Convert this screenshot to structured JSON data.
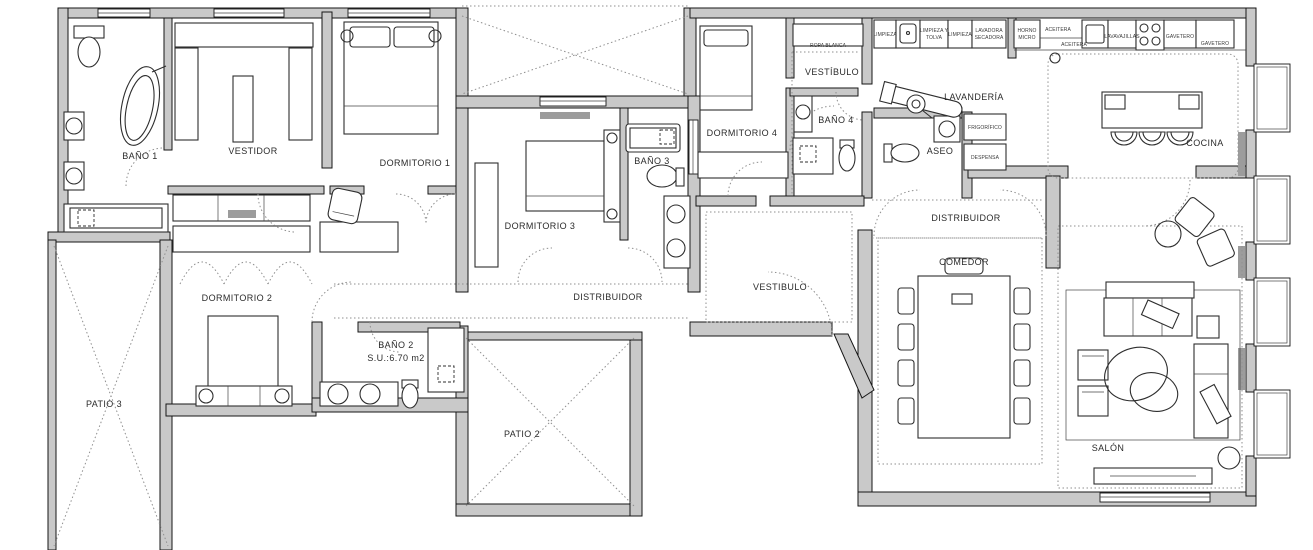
{
  "colors": {
    "wall_fill": "#c9c9c9",
    "line": "#161616",
    "dotted": "#8f8f8f",
    "hatch": "#8f8f8f"
  },
  "rooms": {
    "bano1": "BAÑO 1",
    "vestidor": "VESTIDOR",
    "dormitorio1": "DORMITORIO 1",
    "dormitorio2": "DORMITORIO 2",
    "dormitorio3": "DORMITORIO 3",
    "dormitorio4": "DORMITORIO 4",
    "bano2": "BAÑO 2",
    "bano2_su": "S.U.:6.70 m2",
    "bano3": "BAÑO 3",
    "bano4": "BAÑO 4",
    "aseo": "ASEO",
    "vestibulo_top": "VESTÍBULO",
    "vestibulo_center": "VESTIBULO",
    "lavanderia": "LAVANDERÍA",
    "cocina": "COCINA",
    "comedor": "COMEDOR",
    "salon": "SALÓN",
    "distribuidor_left": "DISTRIBUIDOR",
    "distribuidor_right": "DISTRIBUIDOR",
    "patio2": "PATIO 2",
    "patio3": "PATIO 3"
  },
  "cabinets": {
    "ropa_blanca": "ROPA BLANCA",
    "limpieza1": "LIMPIEZA",
    "limpieza_tolva_1": "LIMPIEZA Y",
    "limpieza_tolva_2": "TOLVA",
    "limpieza2": "LIMPIEZA",
    "lavadora_1": "LAVADORA",
    "lavadora_2": "SECADORA",
    "horno_1": "HORNO",
    "horno_2": "MICRO",
    "aceitera1": "ACEITERA",
    "aceitera2": "ACEITERA",
    "lavavajillas": "LAVAVAJILLAS",
    "gavetero1": "GAVETERO",
    "gavetero2": "GAVETERO",
    "frigorifico": "FRIGORÍFICO",
    "despensa": "DESPENSA"
  }
}
